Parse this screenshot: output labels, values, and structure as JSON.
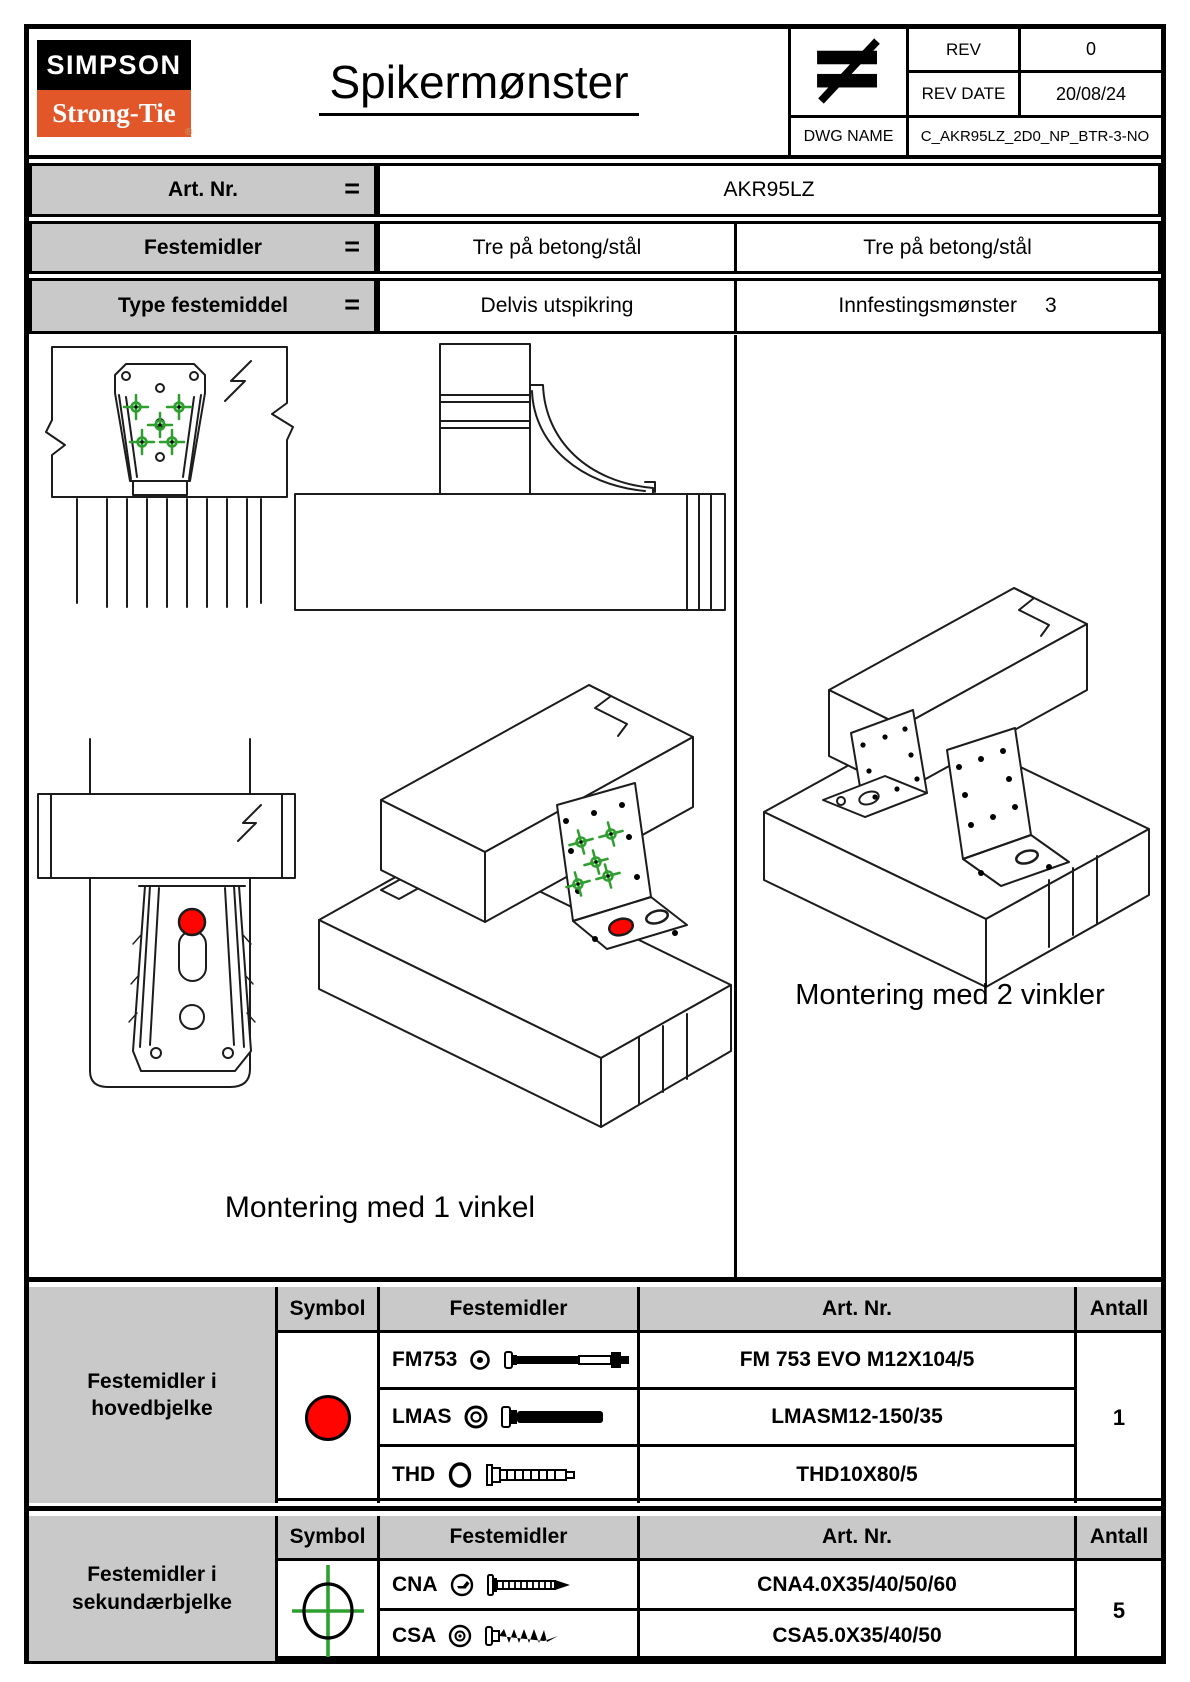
{
  "colors": {
    "brand_orange": "#e2572a",
    "brand_black": "#000000",
    "marker_green": "#2e9f2e",
    "anchor_red": "#ff0400",
    "table_gray": "#c9c9c9"
  },
  "header": {
    "logo_top": "SIMPSON",
    "logo_bottom": "Strong-Tie",
    "logo_reg_mark": "®",
    "title": "Spikermønster",
    "projection_symbol": "first-angle-projection",
    "rev": {
      "label": "REV",
      "value": "0"
    },
    "rev_date": {
      "label": "REV DATE",
      "value": "20/08/24"
    },
    "dwg": {
      "label": "DWG NAME",
      "value": "C_AKR95LZ_2D0_NP_BTR-3-NO"
    }
  },
  "spec_table": {
    "equals": "=",
    "rows": [
      {
        "label": "Art. Nr.",
        "value": "AKR95LZ"
      },
      {
        "label": "Festemidler",
        "value_left": "Tre på betong/stål",
        "value_right": "Tre på betong/stål"
      },
      {
        "label": "Type festemiddel",
        "value_left": "Delvis utspikring",
        "value_right_label": "Innfestingsmønster",
        "value_right_number": "3"
      }
    ]
  },
  "drawings": {
    "caption_single": "Montering med 1 vinkel",
    "caption_double": "Montering med 2 vinkler"
  },
  "fastener_tables": [
    {
      "group_line1": "Festemidler i",
      "group_line2": "hovedbjelke",
      "headers": {
        "symbol": "Symbol",
        "fasteners": "Festemidler",
        "art_nr": "Art. Nr.",
        "qty": "Antall"
      },
      "symbol": "red-filled-circle",
      "rows": [
        {
          "code": "FM753",
          "art_nr": "FM 753 EVO M12X104/5"
        },
        {
          "code": "LMAS",
          "art_nr": "LMASM12-150/35"
        },
        {
          "code": "THD",
          "art_nr": "THD10X80/5"
        }
      ],
      "qty": "1"
    },
    {
      "group_line1": "Festemidler i",
      "group_line2": "sekundærbjelke",
      "headers": {
        "symbol": "Symbol",
        "fasteners": "Festemidler",
        "art_nr": "Art. Nr.",
        "qty": "Antall"
      },
      "symbol": "green-crosshair-circle",
      "rows": [
        {
          "code": "CNA",
          "art_nr": "CNA4.0X35/40/50/60"
        },
        {
          "code": "CSA",
          "art_nr": "CSA5.0X35/40/50"
        }
      ],
      "qty": "5"
    }
  ]
}
